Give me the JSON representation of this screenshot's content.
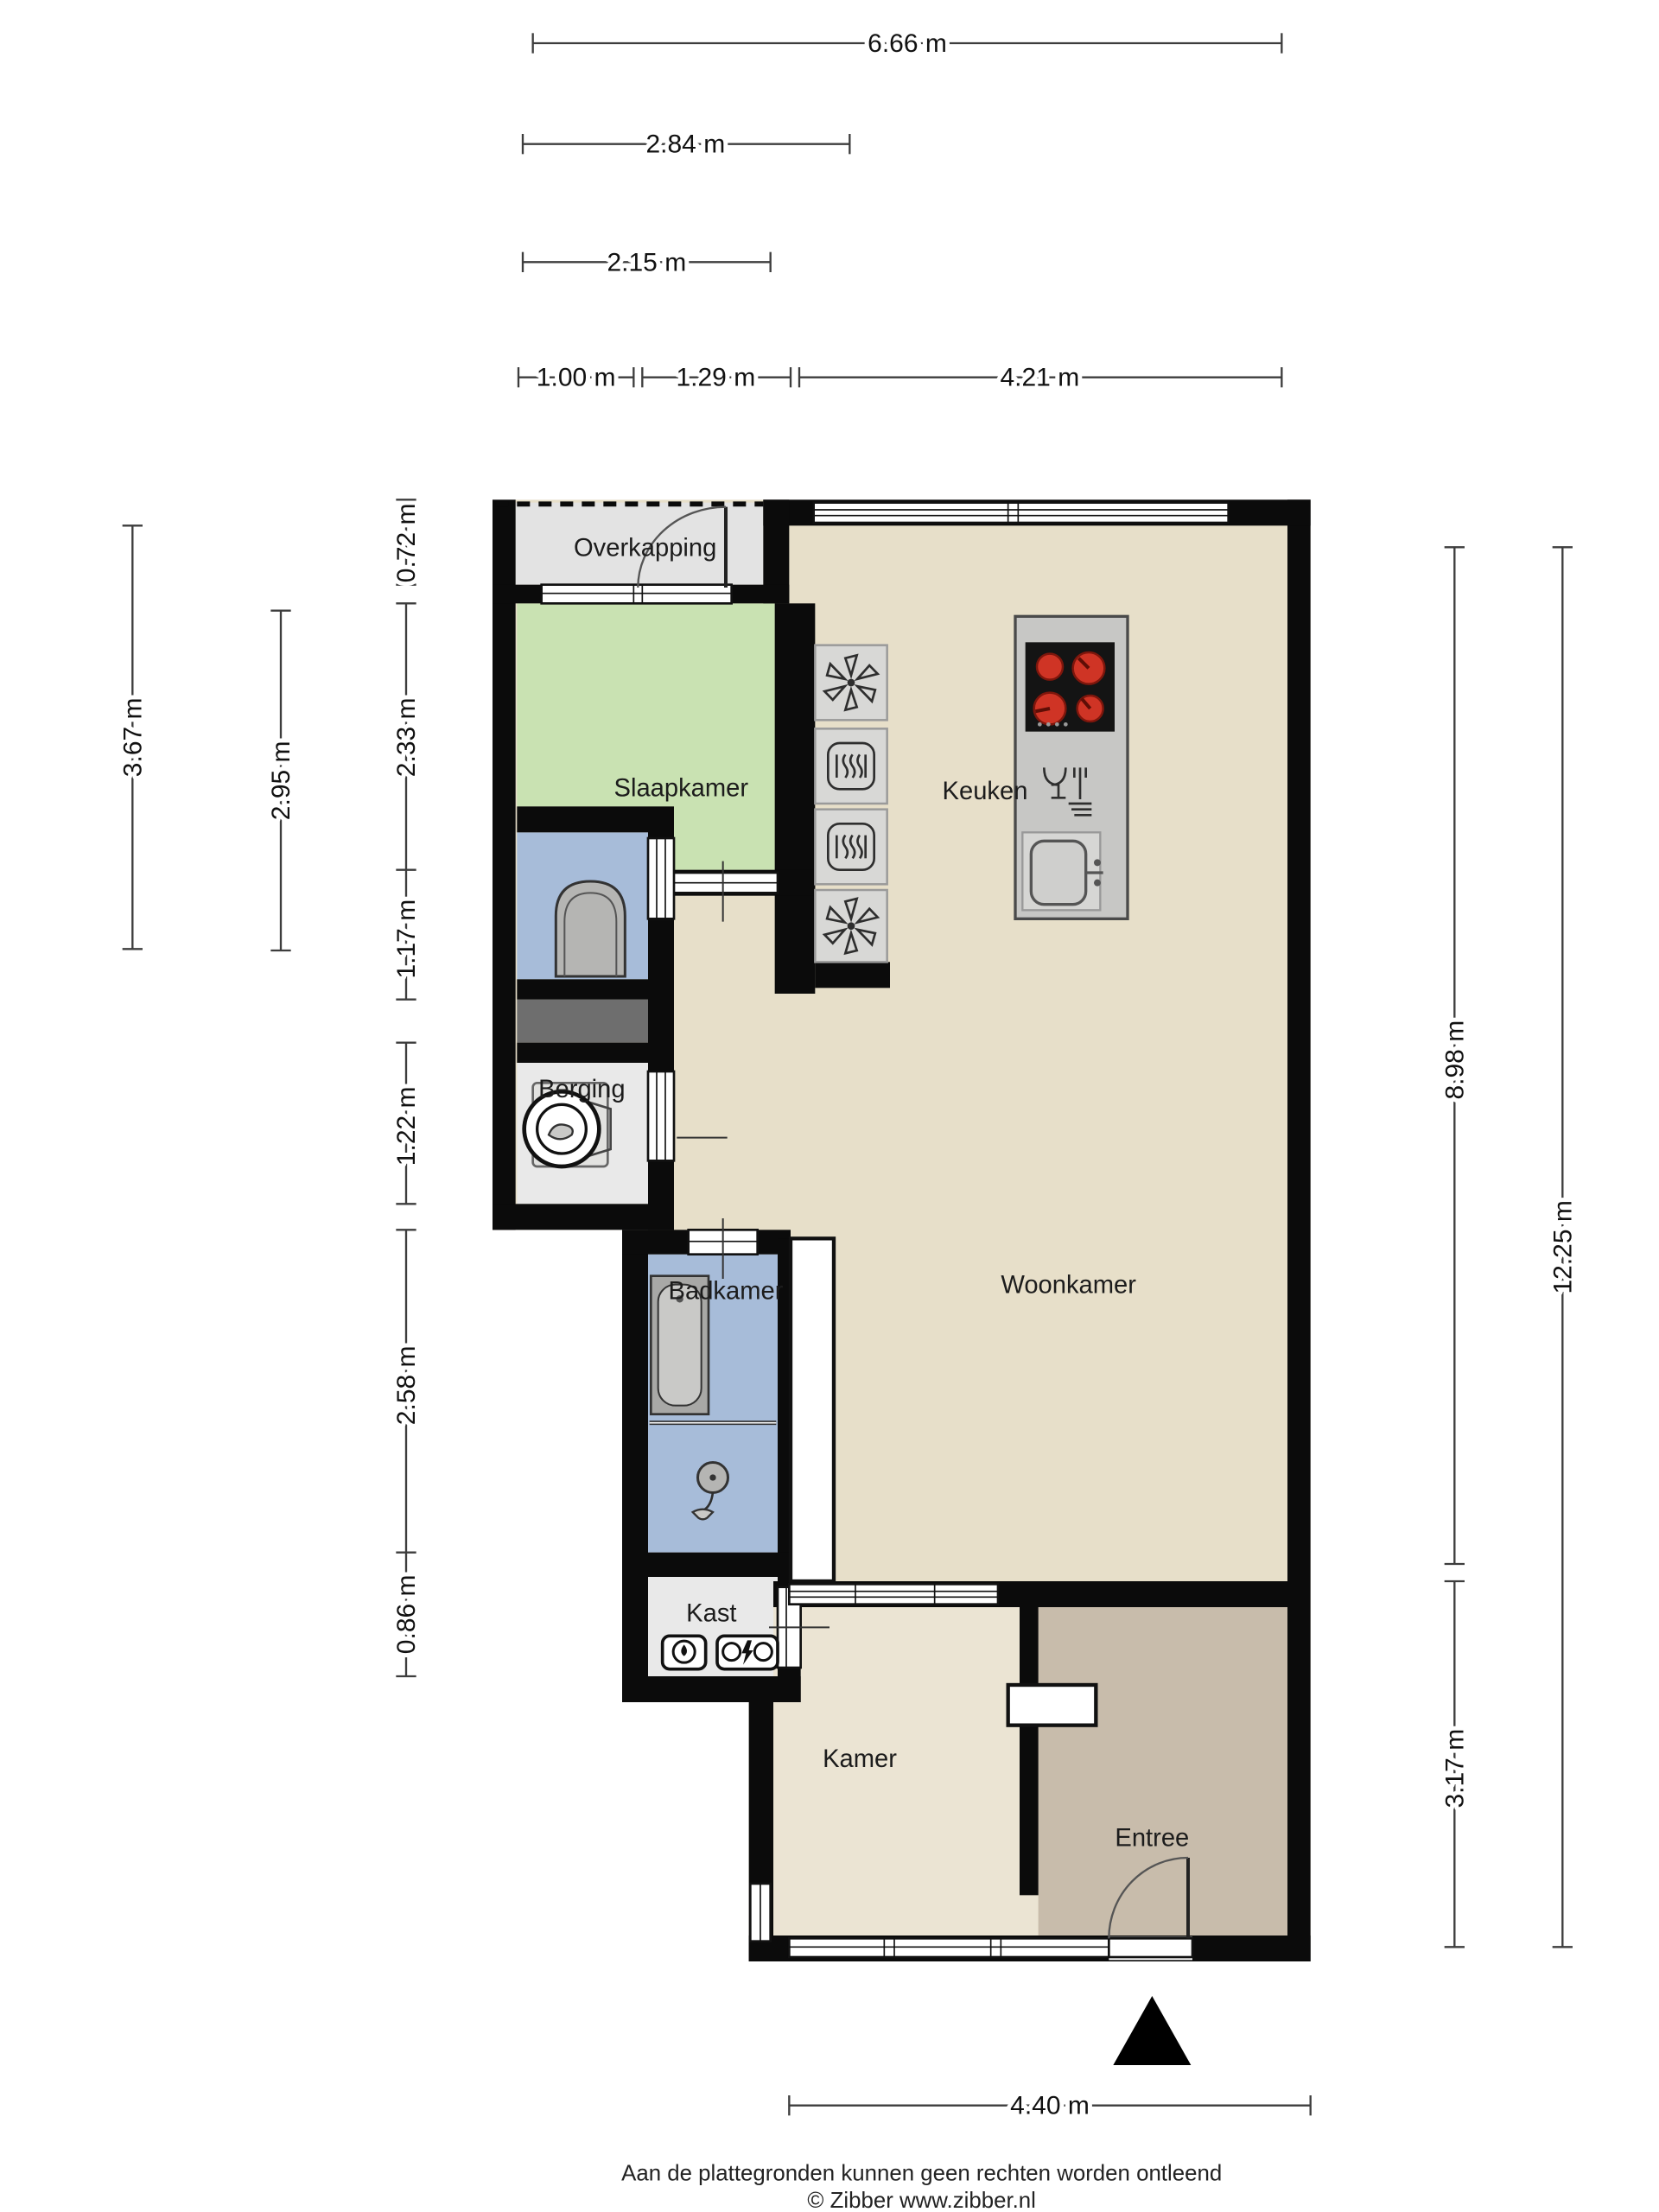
{
  "rooms": {
    "overkapping": {
      "label": "Overkapping"
    },
    "slaapkamer": {
      "label": "Slaapkamer"
    },
    "keuken": {
      "label": "Keuken"
    },
    "berging": {
      "label": "Berging"
    },
    "badkamer": {
      "label": "Badkamer"
    },
    "woonkamer": {
      "label": "Woonkamer"
    },
    "kast": {
      "label": "Kast"
    },
    "kamer": {
      "label": "Kamer"
    },
    "entree": {
      "label": "Entree"
    }
  },
  "dimensions": {
    "top": [
      {
        "label": "6.66 m"
      },
      {
        "label": "2.84 m"
      },
      {
        "label": "2.15 m"
      },
      {
        "label": "1.00 m"
      },
      {
        "label": "1.29 m"
      },
      {
        "label": "4.21 m"
      }
    ],
    "left": [
      {
        "label": "3.67 m"
      },
      {
        "label": "2.95 m"
      },
      {
        "label": "0.72 m"
      },
      {
        "label": "2.33 m"
      },
      {
        "label": "1.17 m"
      },
      {
        "label": "1.22 m"
      },
      {
        "label": "2.58 m"
      },
      {
        "label": "0.86 m"
      }
    ],
    "right": [
      {
        "label": "8.98 m"
      },
      {
        "label": "12.25 m"
      },
      {
        "label": "3.17 m"
      }
    ],
    "bottom": [
      {
        "label": "4.40 m"
      }
    ]
  },
  "footer": {
    "line1": "Aan de plattegronden kunnen geen rechten worden ontleend",
    "line2": "© Zibber www.zibber.nl"
  },
  "colors": {
    "wall": "#0b0b0b",
    "floor_living": "#e7dfc9",
    "floor_kamer": "#ebe4d3",
    "floor_entree": "#c8bcab",
    "floor_bedroom": "#c9e2b2",
    "floor_wet": "#a7bcd9",
    "floor_storage": "#e9e9e9",
    "floor_canopy": "#e3e3e3",
    "shaft": "#6e6e6e",
    "island": "#c7c7c5",
    "cooktop": "#141414",
    "burner": "#cf3425",
    "fixture": "#b5b5b3"
  },
  "icons": {
    "north_marker": "black-triangle",
    "extractor_fan": "six-blade-star",
    "oven": "rounded-square-heat-waves",
    "cooktop": "four-red-burners",
    "dishwasher": "glass-and-fork",
    "sink": "rounded-basin-faucet",
    "toilet": "toilet-top-view",
    "washing_machine": "drum-circle",
    "shower": "shower-head",
    "bathtub": "tub-top-view",
    "meter": "utility-meters"
  }
}
